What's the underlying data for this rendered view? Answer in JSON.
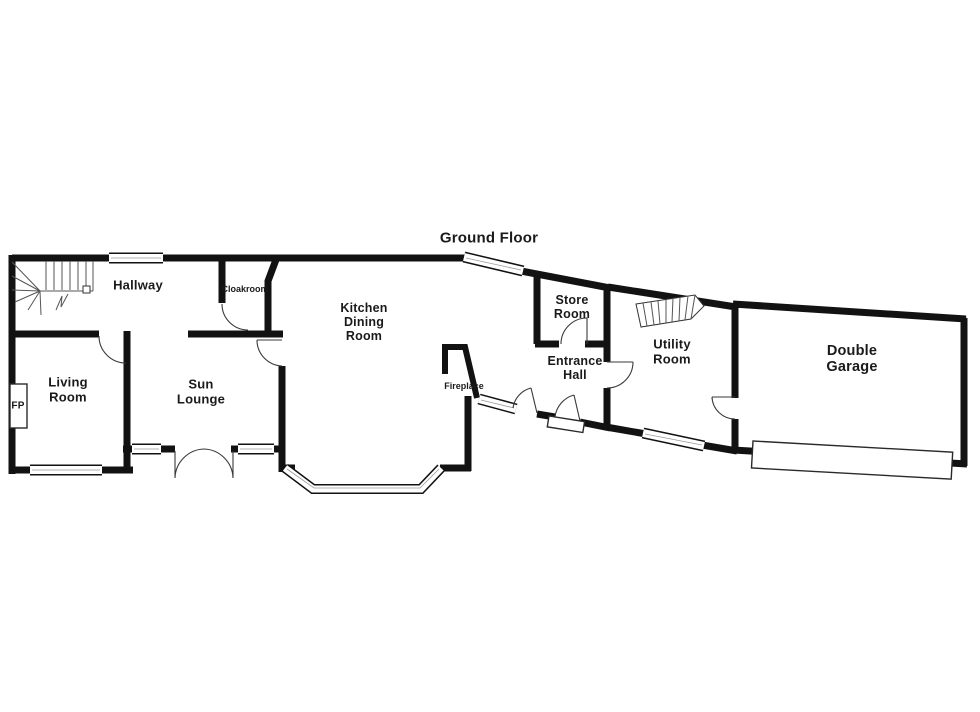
{
  "title": "Ground Floor",
  "rooms": {
    "hallway": {
      "name": "Hallway"
    },
    "cloakroom": {
      "name": "Cloakroom"
    },
    "living_room": {
      "line1": "Living",
      "line2": "Room"
    },
    "sun_lounge": {
      "line1": "Sun",
      "line2": "Lounge"
    },
    "kitchen": {
      "line1": "Kitchen",
      "line2": "Dining",
      "line3": "Room"
    },
    "store_room": {
      "line1": "Store",
      "line2": "Room"
    },
    "entrance_hall": {
      "line1": "Entrance",
      "line2": "Hall"
    },
    "utility_room": {
      "line1": "Utility",
      "line2": "Room"
    },
    "double_garage": {
      "line1": "Double",
      "line2": "Garage"
    }
  },
  "annotations": {
    "fireplace": "Fireplace",
    "fp": "FP"
  },
  "features": {
    "main_staircase": "staircase-icon",
    "utility_staircase": "staircase-icon",
    "bay_window": "bay-window",
    "garage_door": "garage-door",
    "front_door_step": "door-step"
  },
  "colors": {
    "wall": "#121212",
    "background": "#ffffff",
    "text": "#1a1a1a"
  }
}
